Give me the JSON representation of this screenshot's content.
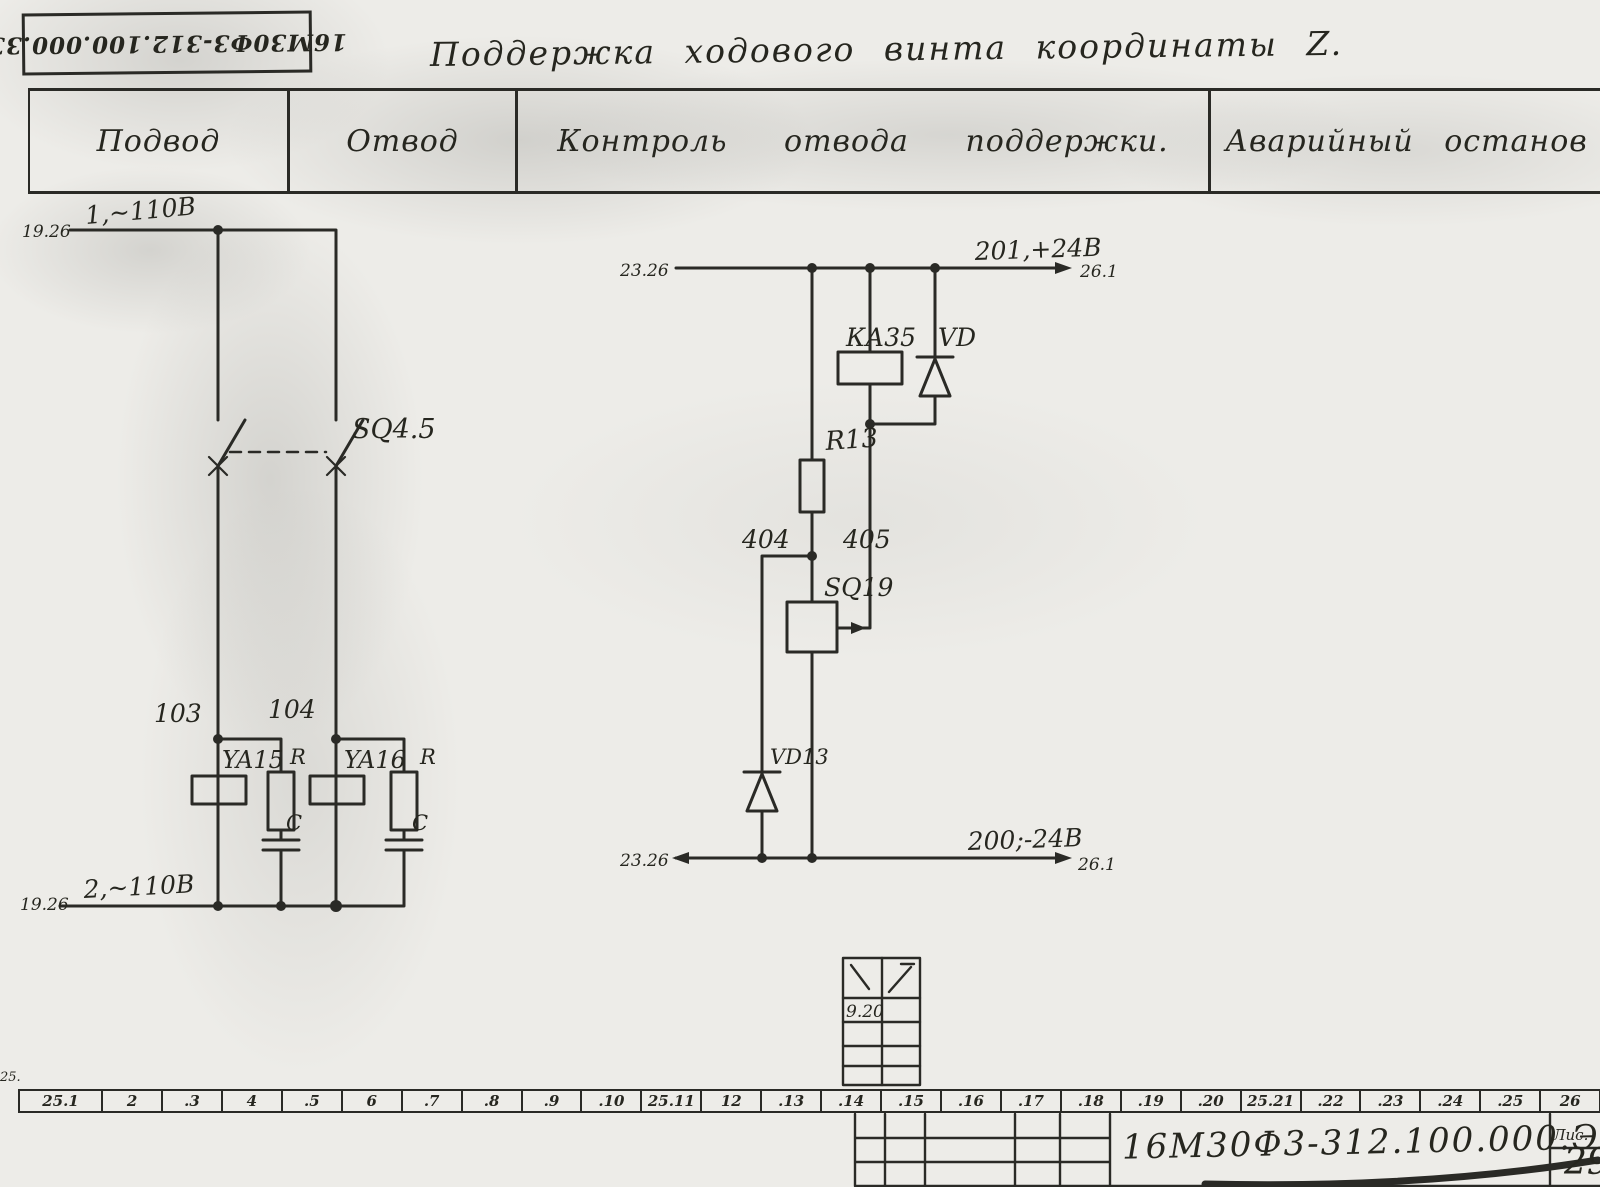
{
  "colors": {
    "ink": "#2a2a26",
    "paper": "#edece8"
  },
  "stamp": {
    "code": "16М30Ф3-312.100.000.33"
  },
  "title": "Поддержка ходового винта координаты Z.",
  "header": {
    "columns": [
      "Подвод",
      "Отвод",
      "Контроль отвода поддержки.",
      "Аварийный останов"
    ]
  },
  "left_circuit": {
    "ref_top": "19.26",
    "wire_top": "1,~110В",
    "ref_bottom": "19.26",
    "wire_bottom": "2,~110В",
    "switch": "SQ4.5",
    "node_a": "103",
    "node_b": "104",
    "coil_a": "YA15",
    "coil_b": "YA16",
    "resistor": "R",
    "capacitor": "C"
  },
  "right_circuit": {
    "ref_left_top": "23.26",
    "wire_top": "201,+24В",
    "ref_right_top": "26.1",
    "relay": "КА35",
    "diode": "VD",
    "resistor": "R13",
    "node_left": "404",
    "node_right": "405",
    "switch": "SQ19",
    "diode_lower": "VD13",
    "ref_left_bottom": "23.26",
    "wire_bottom": "200;-24В",
    "ref_right_bottom": "26.1"
  },
  "mini_table": {
    "value": "9.20"
  },
  "edge_mark": "25.",
  "ruler": {
    "cells": [
      "25.1",
      "2",
      ".3",
      "4",
      ".5",
      "6",
      ".7",
      ".8",
      ".9",
      ".10",
      "25.11",
      "12",
      ".13",
      ".14",
      ".15",
      ".16",
      ".17",
      ".18",
      ".19",
      ".20",
      "25.21",
      ".22",
      ".23",
      ".24",
      ".25",
      "26"
    ]
  },
  "title_block": {
    "doc_number": "16М30Ф3-312.100.000.Э3",
    "sheet_label": "Лис.",
    "sheet_number": "29"
  }
}
